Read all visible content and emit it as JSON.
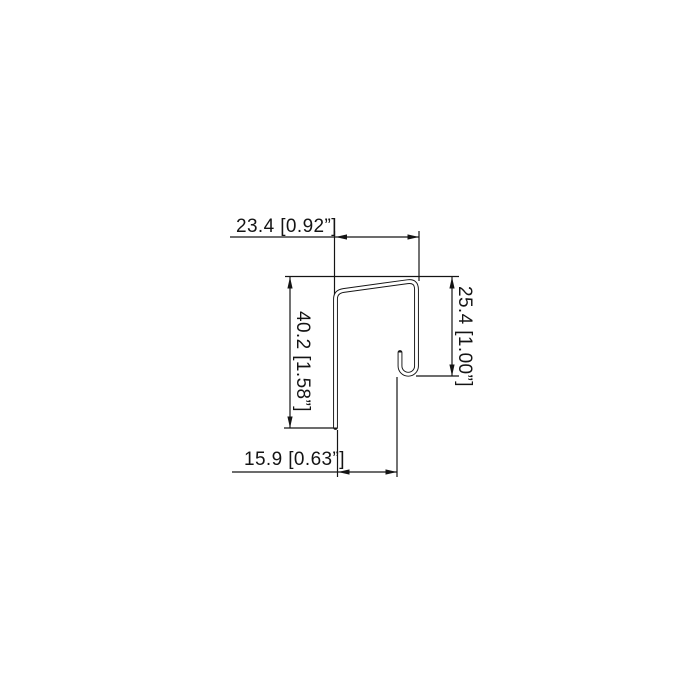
{
  "page": {
    "background": "#ffffff",
    "line_color": "#141414"
  },
  "drawing": {
    "kind": "profile-cross-section",
    "dimensions": {
      "top_width": {
        "label": "23.4 [0.92”]",
        "mm": 23.4,
        "inches": 0.92
      },
      "left_height": {
        "label": "40.2 [1.58”]",
        "mm": 40.2,
        "inches": 1.58
      },
      "right_height": {
        "label": "25.4 [1.00”]",
        "mm": 25.4,
        "inches": 1.0
      },
      "bottom_opening": {
        "label": "15.9 [0.63”]",
        "mm": 15.9,
        "inches": 0.63
      }
    }
  }
}
